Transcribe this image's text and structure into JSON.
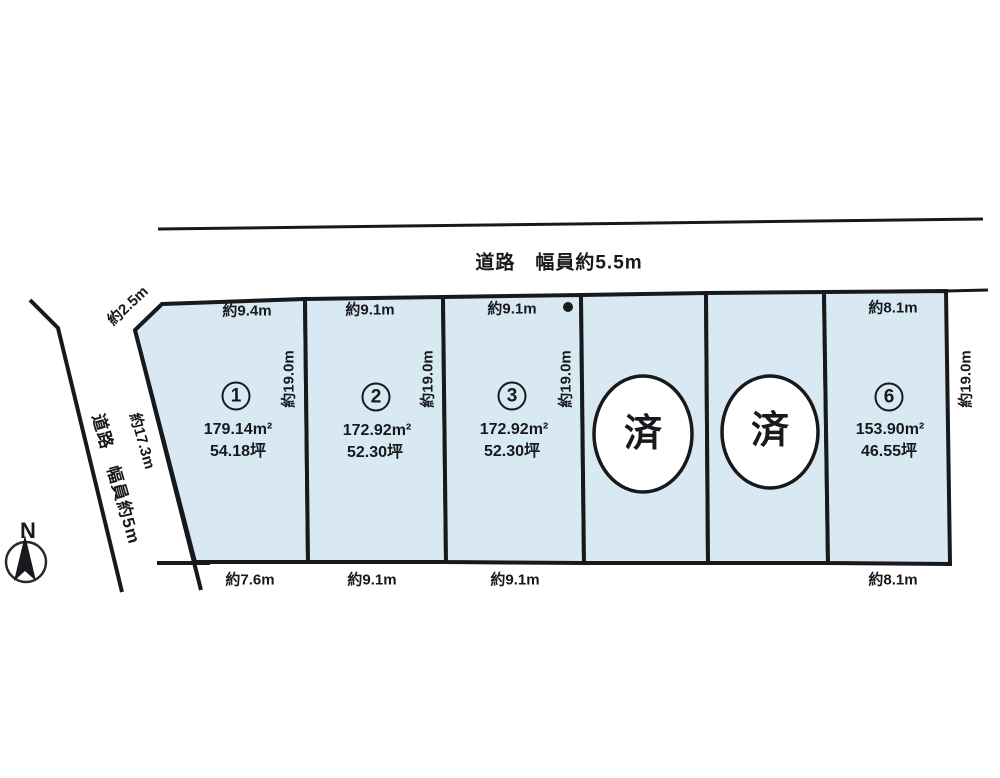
{
  "diagram": {
    "title_note": "宅地分譲区画図",
    "road_top": {
      "label": "道路　幅員約5.5m"
    },
    "road_left": {
      "label": "道路　幅員約5m",
      "edge_length_label": "約17.3m",
      "corner_label": "約2.5m"
    },
    "compass": {
      "label": "N"
    },
    "colors": {
      "plot_fill": "#d9e9f3",
      "line": "#17191c",
      "sold_fill": "#ffffff",
      "background": "#ffffff"
    },
    "plots": [
      {
        "number": "1",
        "status": "available",
        "top": "約9.4m",
        "bottom": "約7.6m",
        "side": "約19.0m",
        "area_m2": "179.14m²",
        "area_tsubo": "54.18坪"
      },
      {
        "number": "2",
        "status": "available",
        "top": "約9.1m",
        "bottom": "約9.1m",
        "side": "約19.0m",
        "area_m2": "172.92m²",
        "area_tsubo": "52.30坪"
      },
      {
        "number": "3",
        "status": "available",
        "top": "約9.1m",
        "bottom": "約9.1m",
        "side": "約19.0m",
        "area_m2": "172.92m²",
        "area_tsubo": "52.30坪"
      },
      {
        "number": "4",
        "status": "sold",
        "sold_label": "済"
      },
      {
        "number": "5",
        "status": "sold",
        "sold_label": "済"
      },
      {
        "number": "6",
        "status": "available",
        "top": "約8.1m",
        "bottom": "約8.1m",
        "side": "約19.0m",
        "area_m2": "153.90m²",
        "area_tsubo": "46.55坪"
      }
    ]
  }
}
